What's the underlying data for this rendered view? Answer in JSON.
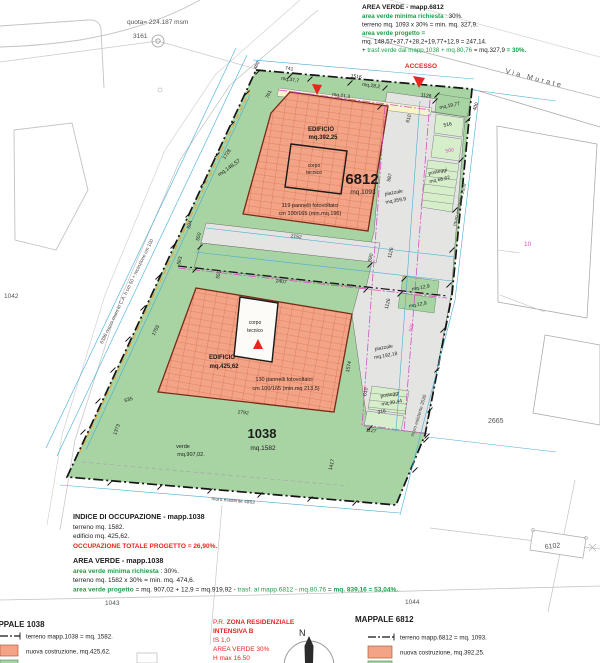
{
  "colors": {
    "verde": "#A8D3A3",
    "verde_chiaro": "#D6EEC9",
    "edificio": "#F3A486",
    "griglia_pannelli": "#CE5F3E",
    "piazzale": "#E4E4E2",
    "percorso": "#F6F3CF",
    "rosso": "#E8251F",
    "testo_verde": "#1E9E48",
    "magenta": "#D94FC6",
    "ciano": "#45AFD6"
  },
  "survey": {
    "quota": "quota= 224.187 msm",
    "point": "3161"
  },
  "street": {
    "name": "Via Murate"
  },
  "access": {
    "label": "ACCESSO"
  },
  "parcels": {
    "p1042": "1042",
    "p1043": "1043",
    "p1044": "1044",
    "p2665": "2665",
    "p10": "10",
    "p6102": "6102"
  },
  "notes_6812": {
    "title": "AREA VERDE - mapp.6812",
    "l1a": "area verde minima richiesta",
    "l1b": " : 30%.",
    "l2": "terreno mq. 1093 x 30% = min. mq. 327,9.",
    "l3": "area verde progetto =",
    "l4": "mq. 148,57+37,7+28,2+19,77+12,9 = 247,14.",
    "l5a": "+ ",
    "l5b": "trasf.verde dal mapp.1038 + mq.80,76",
    "l5c": " = mq.327,9 ",
    "l5d": "= 30%."
  },
  "notes_occupazione": {
    "title": "INDICE DI OCCUPAZIONE - mapp.1038",
    "l1": "terreno mq. 1582.",
    "l2": "edificio mq. 425,62.",
    "l3": "OCCUPAZIONE TOTALE PROGETTO = 26,90%."
  },
  "notes_verde_1038": {
    "title": "AREA VERDE - mapp.1038",
    "l1a": "area verde minima richiesta",
    "l1b": " : 30%.",
    "l2": "terreno mq. 1582 x 30% = min. mq. 474,6.",
    "l3a": "area verde progetto",
    "l3b": " = mq. 907,02 + 12,9 = mq.919,92 - ",
    "l3c": "trasf. al mapp.6812 - mq.80,76",
    "l3d": " = ",
    "l3e": "mq. 839,16 = 53,04%."
  },
  "legend_1038": {
    "title": "MAPPALE 1038",
    "item_terreno": "terreno mapp.1038 = mq. 1582.",
    "item_costruzione": "nuova costruzione, mq.425,62."
  },
  "legend_6812": {
    "title": "MAPPALE 6812",
    "item_terreno": "terreno mapp.6812 = mq. 1093.",
    "item_costruzione": "nuova costruzione, mq.392,25."
  },
  "zoning": {
    "l1a": "P.R. ",
    "l1b": "ZONA RESIDENZIALE",
    "l2": "INTENSIVA B",
    "l3": "IS 1,0",
    "l4": "AREA VERDE 30%",
    "l5": "H max 16.50"
  },
  "compass": {
    "north": "N"
  },
  "plan": {
    "b6812": {
      "edificio": "EDIFICIO",
      "area": "mq.392,25",
      "corpo1": "corpo",
      "corpo2": "tecnico",
      "num": "6812",
      "terreno": "mq.1093",
      "pan1": "119 pannelli fotovoltaici",
      "pan2": "cm 100/165 (min.mq.196)"
    },
    "b1038": {
      "edificio": "EDIFICIO",
      "area": "mq.425,62",
      "corpo1": "corpo",
      "corpo2": "tecnico",
      "pan1": "130 pannelli fotovoltaici",
      "pan2": "cm 100/165 (min.mq 213,5)",
      "num": "1038",
      "terreno": "mq.1582",
      "verde1": "verde",
      "verde2": "mq.907,02."
    },
    "areas": {
      "mq148": "mq.148,57",
      "mq37": "mq.37,7",
      "mq21": "mq.21,3",
      "mq28": "mq.28,2",
      "mq19": "mq.19,77",
      "mq12a": "mq.12,9",
      "mq12b": "mq.12,9",
      "posteggi1a": "posteggi",
      "posteggi1b": "mq 68,62",
      "posteggi2a": "posteggi",
      "posteggi2b": "mq.30,44",
      "piazzale1a": "piazzale",
      "piazzale1b": "mq.359,9",
      "piazzale2a": "piazzale",
      "piazzale2b": "mq.192,18"
    },
    "walls": {
      "left": "6386 nuovo muro in C.A. h cm 50 + recinzione cm 100",
      "bottom": "muro esistente 4863",
      "right_top": "muro esistente 2609",
      "right_bottom": "muro esistente 3530"
    },
    "dims": {
      "d741": "741",
      "d460": "460",
      "d761": "761",
      "d1516": "1516",
      "d1126a": "1126",
      "d400": "400",
      "d610a": "610",
      "d516": "516",
      "d500a": "500",
      "d587": "587",
      "d1728": "1728",
      "d2152": "2152",
      "d594": "594",
      "d550a": "550",
      "d563": "563",
      "d550b": "550",
      "d2407": "2407",
      "d1126b": "1126",
      "d1126c": "1126",
      "d590": "590",
      "d500b": "500",
      "d1574": "1574",
      "d610b": "610",
      "d316": "316",
      "d1127": "1127",
      "d1417": "1417",
      "d2792": "2792",
      "d635": "635",
      "d1373": "1373",
      "d1755": "1755"
    }
  }
}
